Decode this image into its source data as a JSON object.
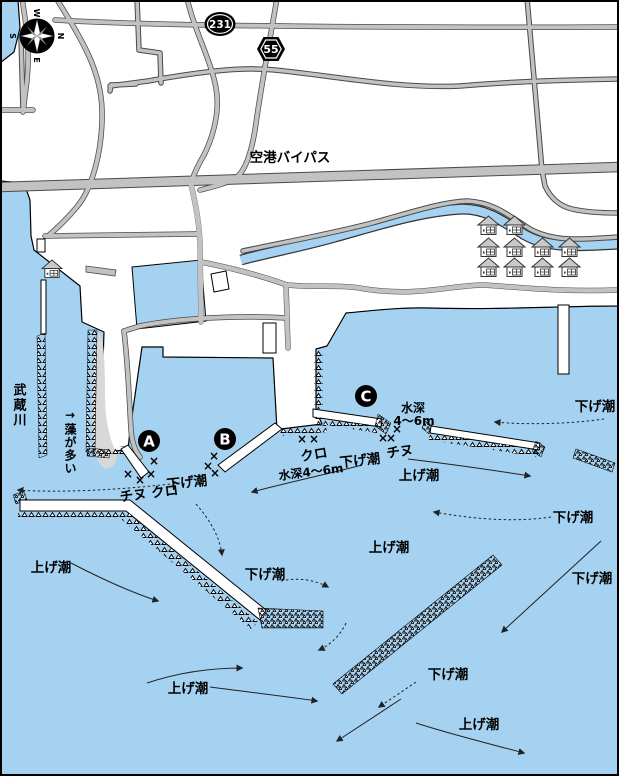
{
  "map": {
    "title_note": "harbor fishing map",
    "compass": {
      "n": "N",
      "e": "E",
      "s": "S",
      "w": "W"
    },
    "route_badges": {
      "r231": "231",
      "r55": "55"
    },
    "roads": {
      "bypass_label": "空港バイパス"
    },
    "water": {
      "river_label": "武蔵川"
    },
    "notes": {
      "seaweed": "→藻が多い"
    },
    "points": [
      {
        "label": "A"
      },
      {
        "label": "B"
      },
      {
        "label": "C"
      }
    ],
    "fishing": {
      "a_fish": "チヌ クロ",
      "b_fish": "クロ",
      "b_depth": "水深4～6m",
      "c_fish": "チヌ",
      "c_depth_line1": "水深",
      "c_depth_line2": "4～6m"
    },
    "marker_char": "×",
    "tides": [
      {
        "text": "下げ潮"
      },
      {
        "text": "下げ潮"
      },
      {
        "text": "下げ潮"
      },
      {
        "text": "下げ潮"
      },
      {
        "text": "上げ潮"
      },
      {
        "text": "上げ潮"
      },
      {
        "text": "下げ潮"
      },
      {
        "text": "上げ潮"
      },
      {
        "text": "上げ潮"
      },
      {
        "text": "下げ潮"
      },
      {
        "text": "上げ潮"
      },
      {
        "text": "下げ潮"
      }
    ]
  }
}
